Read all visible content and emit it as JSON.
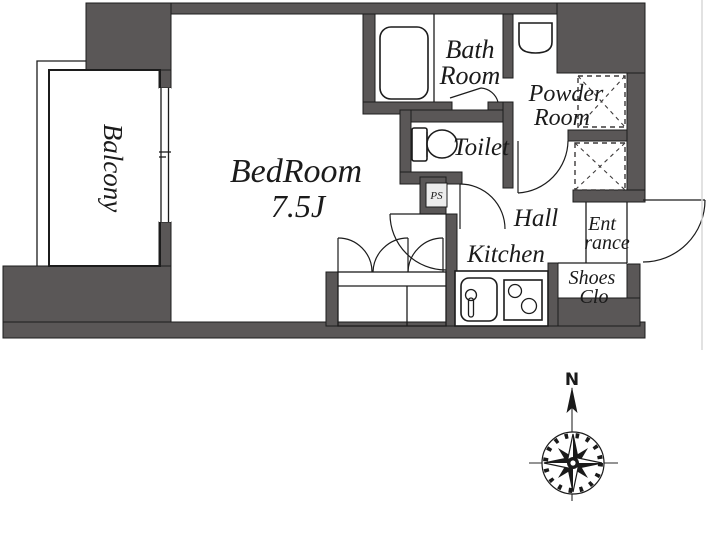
{
  "colors": {
    "wall": "#5a5757",
    "line": "#1c1c1c",
    "text": "#1b1b1b",
    "paper": "#ffffff",
    "artifact": "#d9d9d9"
  },
  "rooms": {
    "balcony": {
      "label": "Balcony"
    },
    "bedroom": {
      "label": "BedRoom",
      "size": "7.5J"
    },
    "bathroom": {
      "line1": "Bath",
      "line2": "Room"
    },
    "toilet": {
      "label": "Toilet"
    },
    "powder": {
      "line1": "Powder",
      "line2": "Room"
    },
    "hall": {
      "label": "Hall"
    },
    "kitchen": {
      "label": "Kitchen"
    },
    "entrance": {
      "line1": "Ent",
      "line2": "rance"
    },
    "shoes": {
      "line1": "Shoes",
      "line2": "Clo"
    },
    "pipe_space": {
      "label": "PS"
    }
  },
  "compass": {
    "north_label": "N"
  }
}
